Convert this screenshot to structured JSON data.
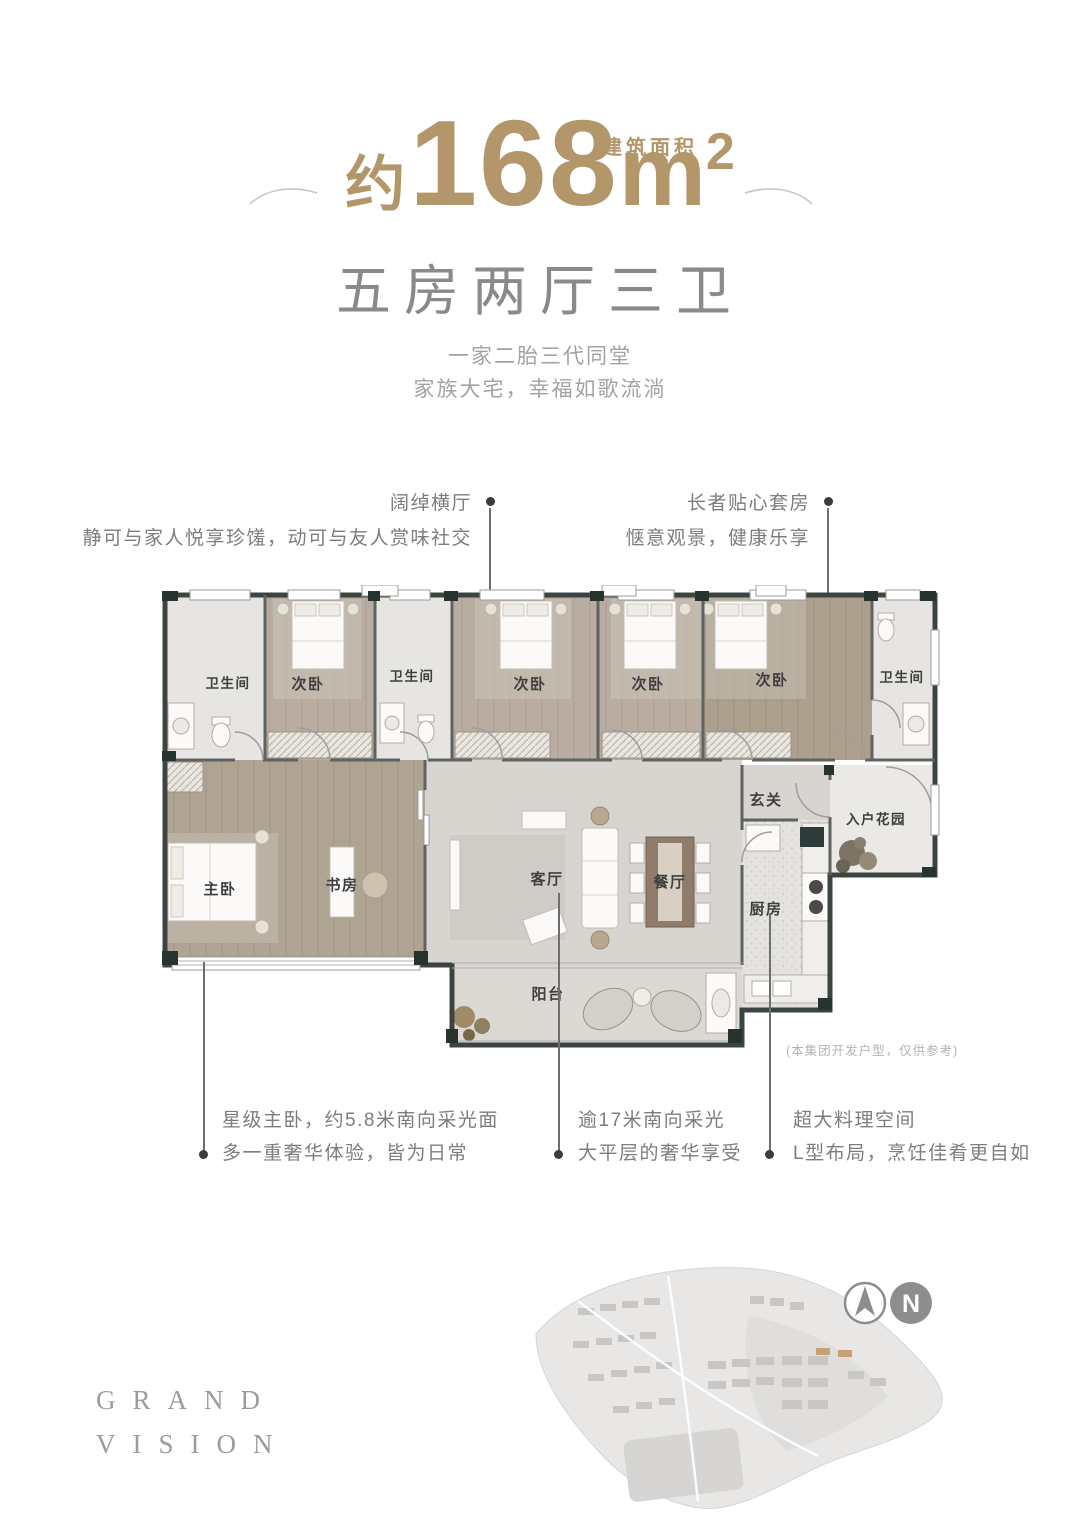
{
  "palette": {
    "accent_gold": "#b3976a",
    "heading_gray": "#8a8a8a",
    "wall_dark": "#2c3936",
    "wood_floor": "#b2a695",
    "marble_floor": "#d8d5d1"
  },
  "header": {
    "area_label": "建筑面积",
    "approx": "约",
    "area_number": "168",
    "area_unit": "m",
    "area_exponent": "2",
    "layout_title": "五房两厅三卫",
    "tagline_line1": "一家二胎三代同堂",
    "tagline_line2": "家族大宅，幸福如歌流淌"
  },
  "callouts": {
    "hall": {
      "title": "阔绰横厅",
      "desc": "静可与家人悦享珍馐，动可与友人赏味社交"
    },
    "elder_suite": {
      "title": "长者贴心套房",
      "desc": "惬意观景，健康乐享"
    },
    "master": {
      "line1": "星级主卧，约5.8米南向采光面",
      "line2": "多一重奢华体验，皆为日常"
    },
    "lighting": {
      "line1": "逾17米南向采光",
      "line2": "大平层的奢华享受"
    },
    "kitchen": {
      "line1": "超大料理空间",
      "line2": "L型布局，烹饪佳肴更自如"
    }
  },
  "floor_plan": {
    "disclaimer": "(本集团开发户型，仅供参考)",
    "rooms": [
      {
        "id": "bath-1",
        "label": "卫生间"
      },
      {
        "id": "bedroom-1",
        "label": "次卧"
      },
      {
        "id": "bath-2",
        "label": "卫生间"
      },
      {
        "id": "bedroom-2",
        "label": "次卧"
      },
      {
        "id": "bedroom-3",
        "label": "次卧"
      },
      {
        "id": "bedroom-4",
        "label": "次卧"
      },
      {
        "id": "bath-3",
        "label": "卫生间"
      },
      {
        "id": "foyer",
        "label": "玄关"
      },
      {
        "id": "entry-garden",
        "label": "入户花园"
      },
      {
        "id": "master-bedroom",
        "label": "主卧"
      },
      {
        "id": "study",
        "label": "书房"
      },
      {
        "id": "living-room",
        "label": "客厅"
      },
      {
        "id": "dining-room",
        "label": "餐厅"
      },
      {
        "id": "kitchen",
        "label": "厨房"
      },
      {
        "id": "balcony",
        "label": "阳台"
      }
    ]
  },
  "footer": {
    "brand_line1": "GRAND",
    "brand_line2": "VISION",
    "compass_letter": "N"
  }
}
